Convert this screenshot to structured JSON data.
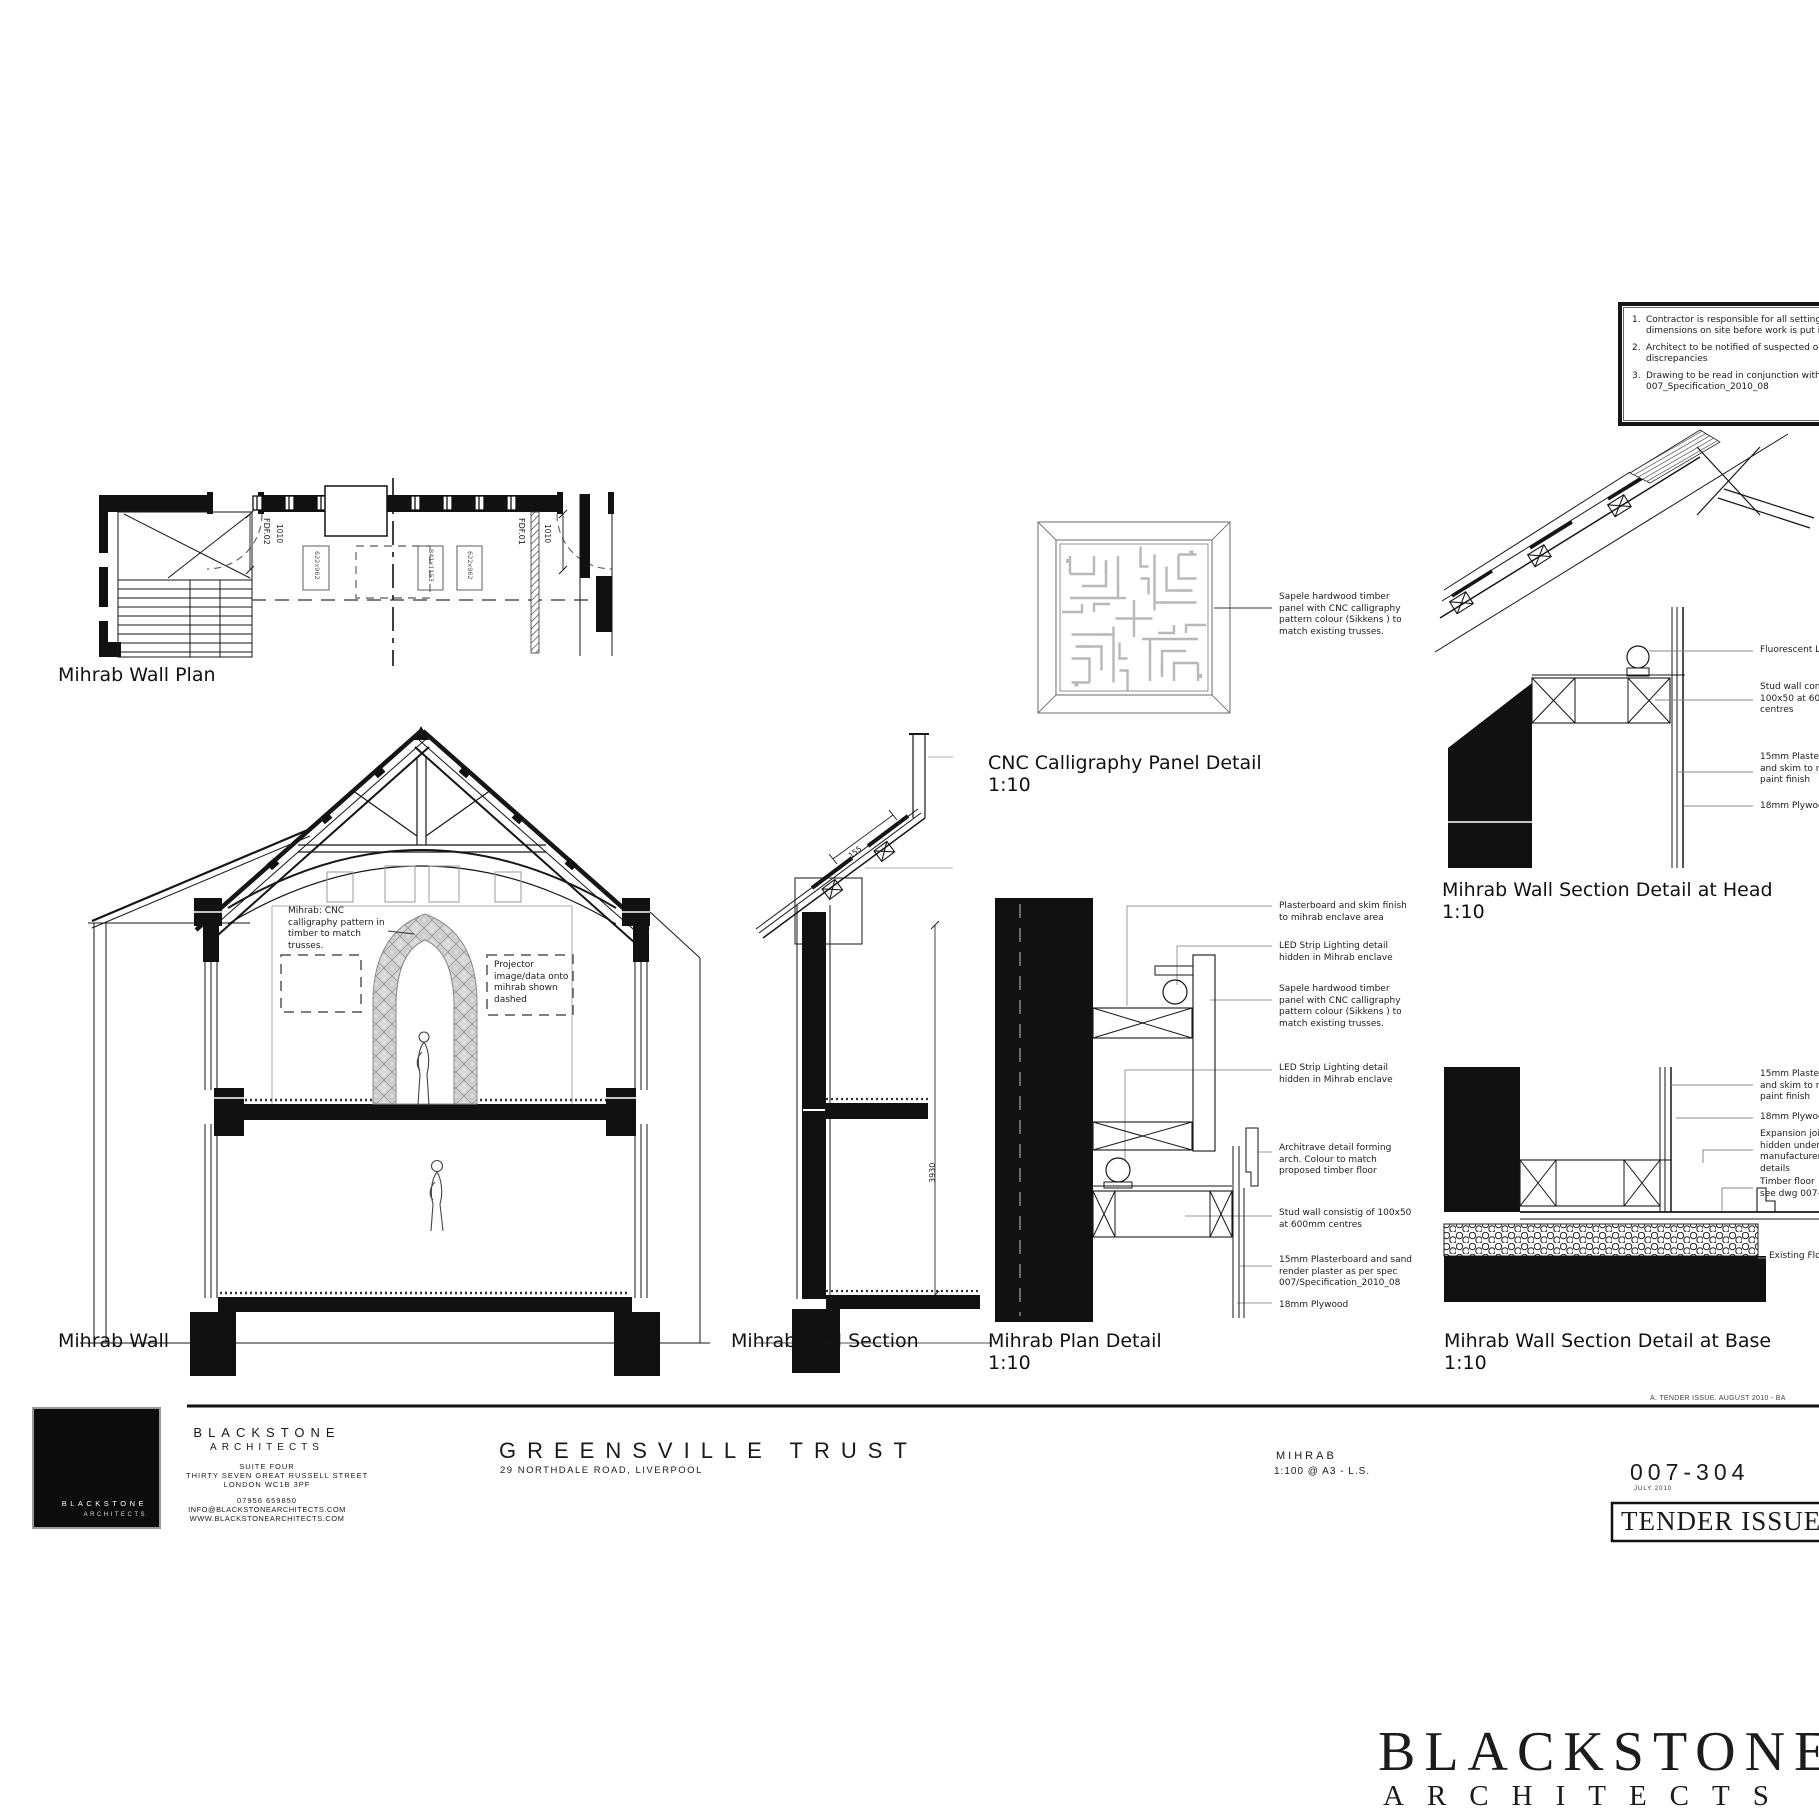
{
  "sheet": {
    "notes": {
      "items": [
        "Contractor is responsible for all setting out and check dimensions on site before work is put in",
        "Architect to be notified of suspected omissions discrepancies",
        "Drawing to be read in conjunction with specification 007_Specification_2010_08"
      ]
    },
    "plan": {
      "caption": "Mihrab Wall Plan",
      "door_left": "FDF.02",
      "door_left_width": "1010",
      "door_right": "FDF.01",
      "door_right_width": "1010",
      "sizes": [
        "622x962",
        "841x1153",
        "622x962"
      ]
    },
    "elevation": {
      "caption": "Mihrab Wall",
      "mihrab_note": "Mihrab: CNC\ncalligraphy pattern in\ntimber to match\ntrusses.",
      "projector_note": "Projector\nimage/data onto\nmihrab shown\ndashed"
    },
    "section": {
      "caption": "Mihrab Wall Section",
      "height_dim": "3930",
      "roof_dim": "155"
    },
    "cnc": {
      "caption": "CNC Calligraphy Panel Detail",
      "scale": "1:10",
      "sapele_note": "Sapele hardwood timber\npanel with CNC calligraphy\npattern colour (Sikkens ) to\nmatch existing trusses."
    },
    "head": {
      "caption": "Mihrab Wall Section Detail at Head",
      "scale": "1:10",
      "labels": [
        "Fluorescent Light",
        "Stud wall consisting\n100x50 at 600mm\ncentres",
        "15mm Plasterboard\nand skim to receive\npaint finish",
        "18mm Plywood"
      ]
    },
    "plan_detail": {
      "caption": "Mihrab Plan Detail",
      "scale": "1:10",
      "labels": [
        "Plasterboard and skim finish\nto mihrab enclave area",
        "LED Strip Lighting detail\nhidden in Mihrab enclave",
        "Sapele hardwood timber\npanel with CNC calligraphy\npattern colour (Sikkens ) to\nmatch existing trusses.",
        "LED Strip Lighting detail\nhidden in Mihrab enclave",
        "Architrave detail forming\narch. Colour to match\nproposed timber floor",
        "Stud wall consistig of 100x50\nat 600mm centres",
        "15mm Plasterboard and sand\nrender plaster as per spec\n007/Specification_2010_08",
        "18mm Plywood"
      ]
    },
    "base": {
      "caption": "Mihrab Wall Section Detail at Base",
      "scale": "1:10",
      "labels": [
        "15mm Plasterboard\nand skim to receive\npaint finish",
        "18mm Plywood",
        "Expansion joint\nhidden under\nmanufacturers\ndetails",
        "Timber floor\nsee dwg 007-",
        "Existing Floor"
      ]
    },
    "titleblock": {
      "firm": "BLACKSTONE",
      "firm_sub": "ARCHITECTS",
      "address1": "SUITE FOUR",
      "address2": "THIRTY SEVEN GREAT RUSSELL STREET",
      "address3": "LONDON WC1B 3PF",
      "phone": "07956 659850",
      "email": "INFO@BLACKSTONEARCHITECTS.COM",
      "web": "WWW.BLACKSTONEARCHITECTS.COM",
      "project": "GREENSVILLE TRUST",
      "project_address": "29 NORTHDALE ROAD, LIVERPOOL",
      "drawing": "MIHRAB",
      "scale": "1:100 @ A3  -  L.S.",
      "number": "007-304",
      "date": "JULY 2010",
      "status": "TENDER ISSUE",
      "revision": "A.  TENDER ISSUE. AUGUST 2010 - BA",
      "logo_line1": "BLACKSTONE",
      "logo_line2": "ARCHITECTS"
    },
    "brand": {
      "wordmark": "BLACKSTONE",
      "wordmark_sub": "ARCHITECTS"
    }
  }
}
